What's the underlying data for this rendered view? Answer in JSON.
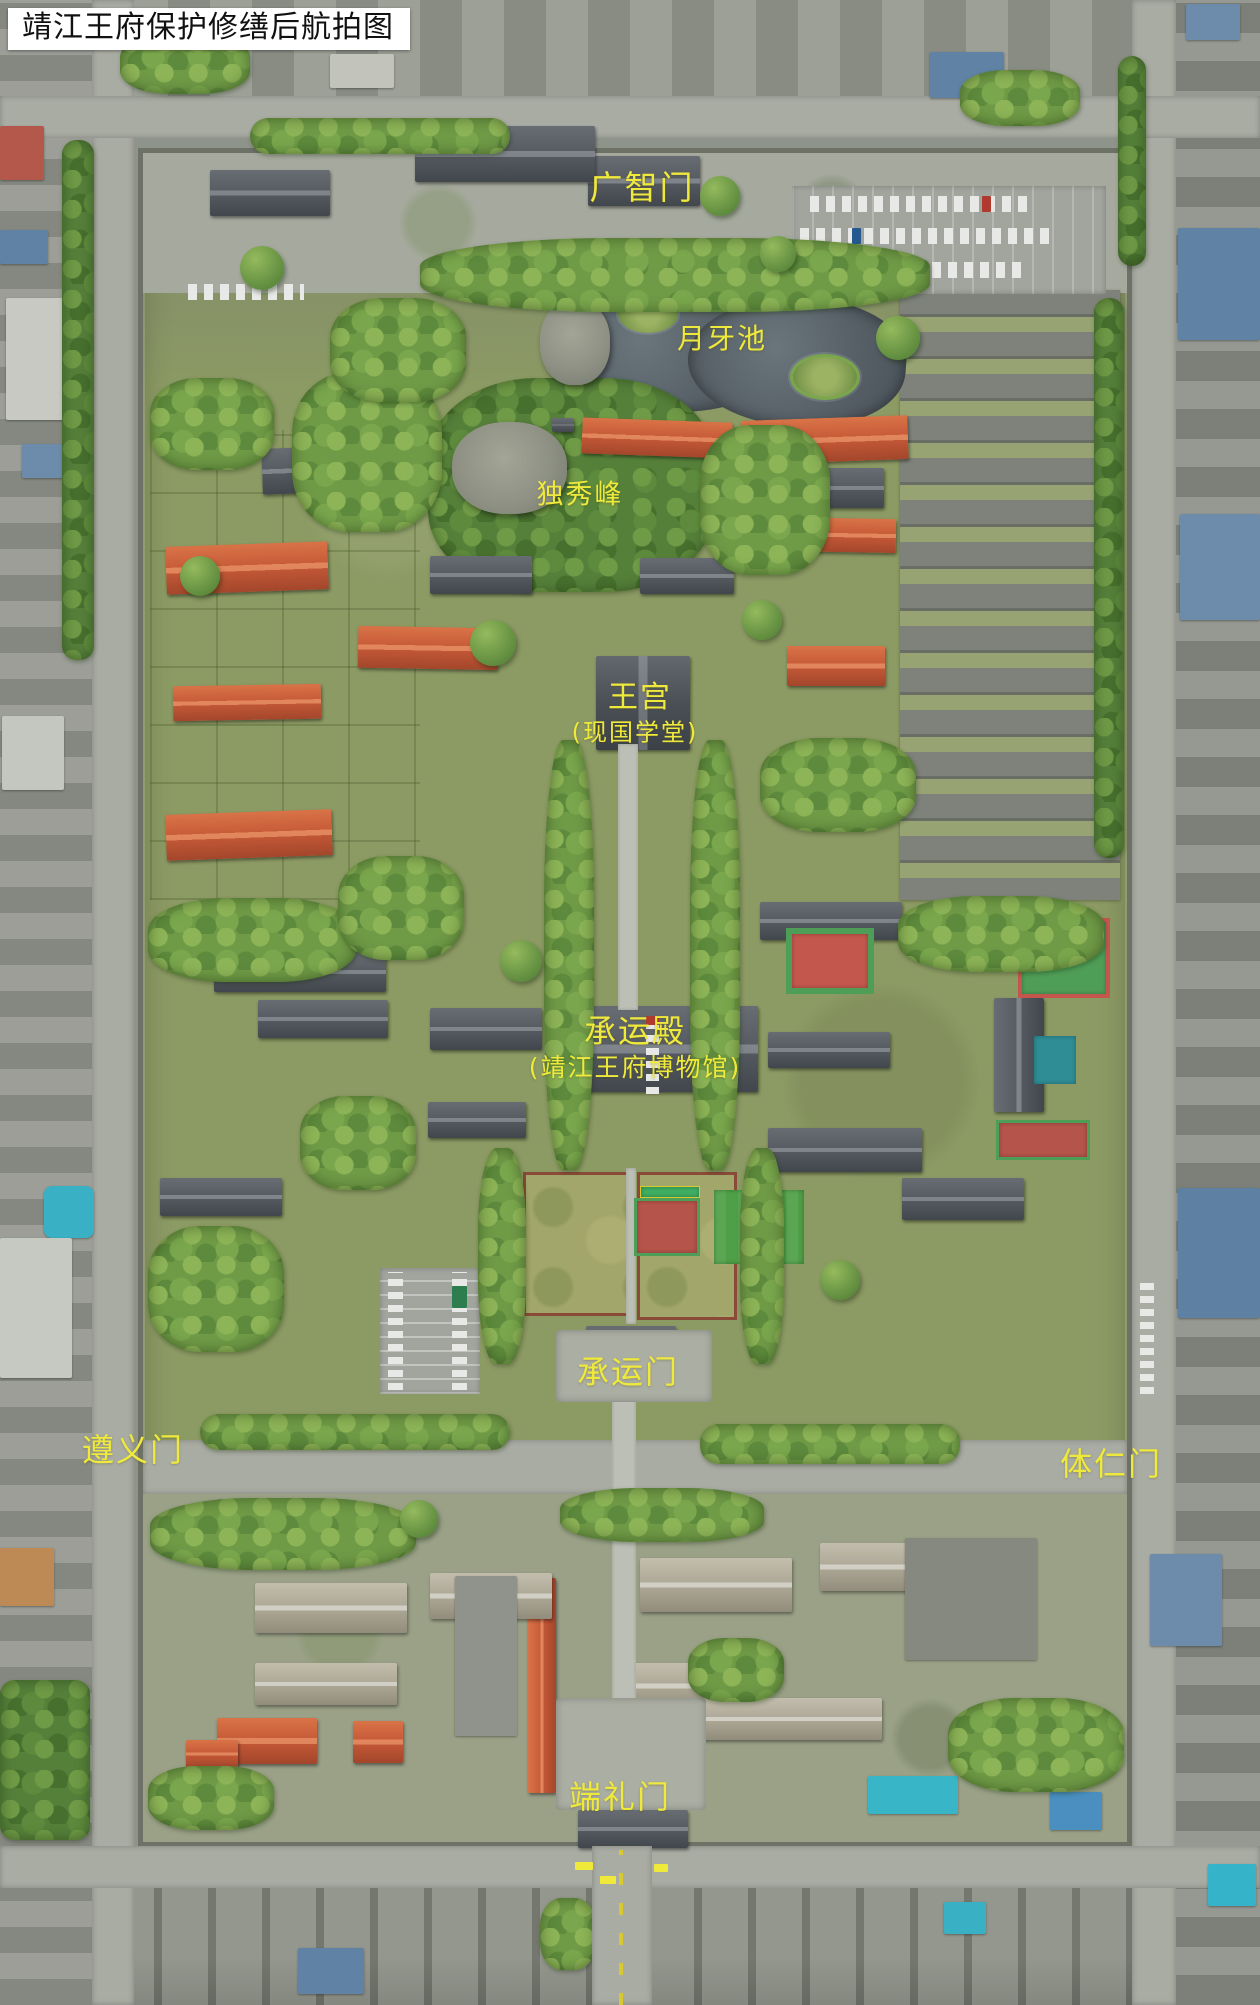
{
  "title": "靖江王府保护修缮后航拍图",
  "labels": {
    "guangzhimen": "广智门",
    "yueyachi": "月牙池",
    "duxiufeng": "独秀峰",
    "wanggong": "王宫",
    "wanggong_sub": "(现国学堂)",
    "chengyundian": "承运殿",
    "chengyundian_sub": "(靖江王府博物馆)",
    "chengyunmen": "承运门",
    "zunyimen": "遵义门",
    "tirenmen": "体仁门",
    "duanlimen": "端礼门"
  },
  "colors": {
    "label_yellow": "#efe93c",
    "title_text": "#111111",
    "title_bg": "#ffffff",
    "pond_water": "#59646b",
    "orange_roof": "#c65a38",
    "dark_roof": "#50555b",
    "lawn_green": "#a2a66a",
    "court_red": "#c4574d",
    "court_green": "#4f9e58",
    "court_teal": "#2f8d95",
    "tarp_cyan": "#38b6c8",
    "blue_roof": "#5f82a5"
  }
}
